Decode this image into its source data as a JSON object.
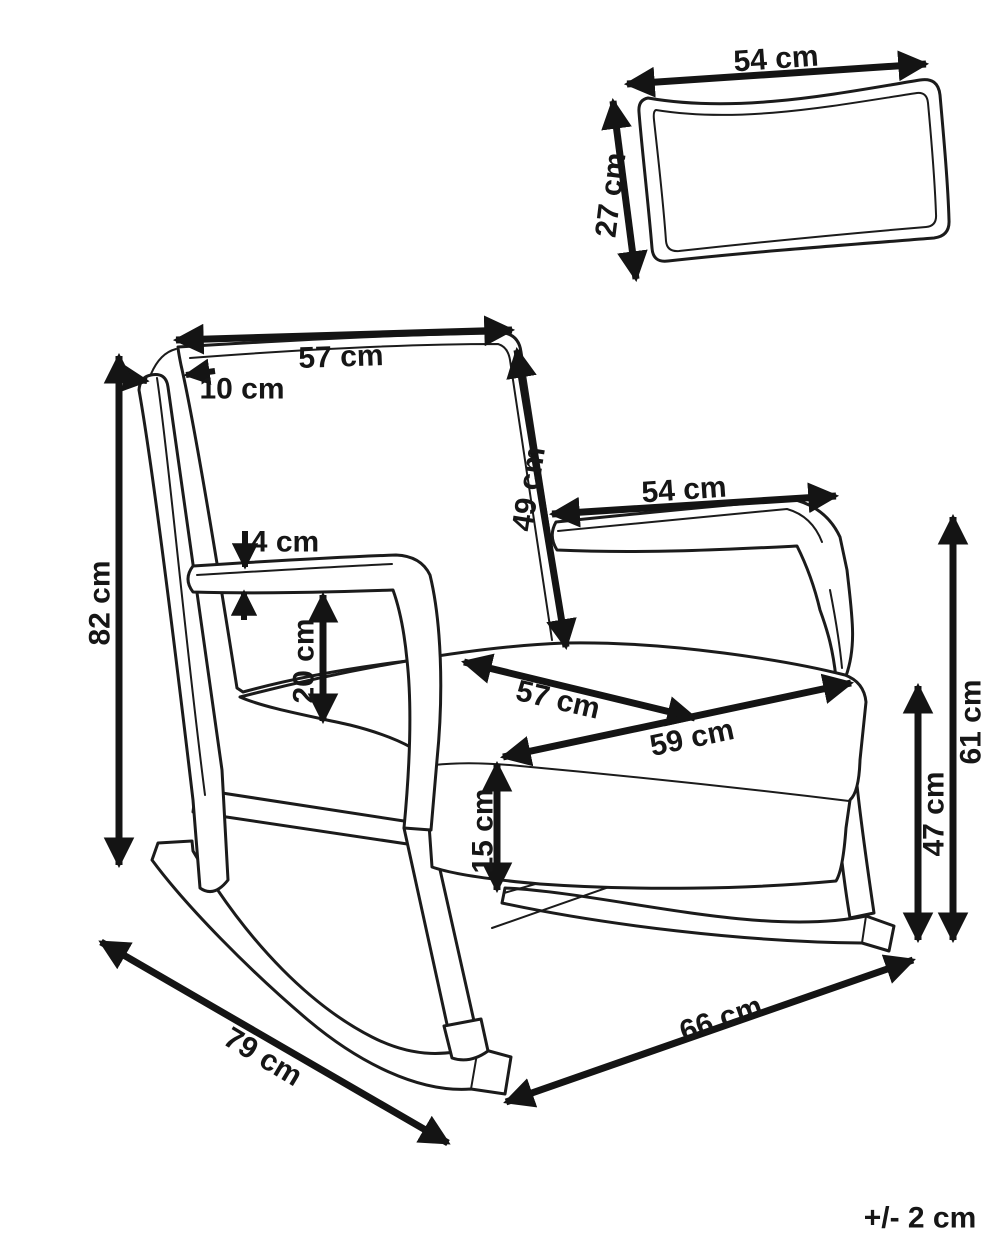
{
  "diagram": {
    "subject": "rocking-chair-with-cushion-dimensions",
    "background_color": "#ffffff",
    "line_color": "#1b1b1b",
    "dimension_color": "#141414",
    "unit": "cm"
  },
  "labels": [
    {
      "name": "pillow-width",
      "text": "54 cm",
      "x": 776,
      "y": 59,
      "rot": -4
    },
    {
      "name": "pillow-depth",
      "text": "27 cm",
      "x": 611,
      "y": 195,
      "rot": -83
    },
    {
      "name": "backrest-width",
      "text": "57 cm",
      "x": 341,
      "y": 357,
      "rot": -2
    },
    {
      "name": "headrest-post-width",
      "text": "10 cm",
      "x": 242,
      "y": 389,
      "rot": 0
    },
    {
      "name": "backrest-height",
      "text": "49 cm",
      "x": 529,
      "y": 489,
      "rot": -81
    },
    {
      "name": "armrest-length",
      "text": "54 cm",
      "x": 684,
      "y": 490,
      "rot": -4
    },
    {
      "name": "overall-height",
      "text": "82 cm",
      "x": 100,
      "y": 603,
      "rot": -90
    },
    {
      "name": "armrest-thickness",
      "text": "4 cm",
      "x": 285,
      "y": 542,
      "rot": 0
    },
    {
      "name": "armrest-to-seat",
      "text": "20 cm",
      "x": 304,
      "y": 661,
      "rot": -90
    },
    {
      "name": "seat-depth",
      "text": "57 cm",
      "x": 558,
      "y": 700,
      "rot": 13
    },
    {
      "name": "seat-width",
      "text": "59 cm",
      "x": 692,
      "y": 738,
      "rot": -12
    },
    {
      "name": "cushion-thickness",
      "text": "15 cm",
      "x": 483,
      "y": 831,
      "rot": -90
    },
    {
      "name": "seat-height",
      "text": "47 cm",
      "x": 934,
      "y": 814,
      "rot": -90
    },
    {
      "name": "armrest-height",
      "text": "61 cm",
      "x": 971,
      "y": 722,
      "rot": -90
    },
    {
      "name": "overall-depth",
      "text": "79 cm",
      "x": 263,
      "y": 1057,
      "rot": 31
    },
    {
      "name": "overall-width",
      "text": "66 cm",
      "x": 721,
      "y": 1019,
      "rot": -19
    },
    {
      "name": "tolerance-note",
      "text": "+/- 2 cm",
      "x": 920,
      "y": 1218,
      "rot": 0
    }
  ]
}
